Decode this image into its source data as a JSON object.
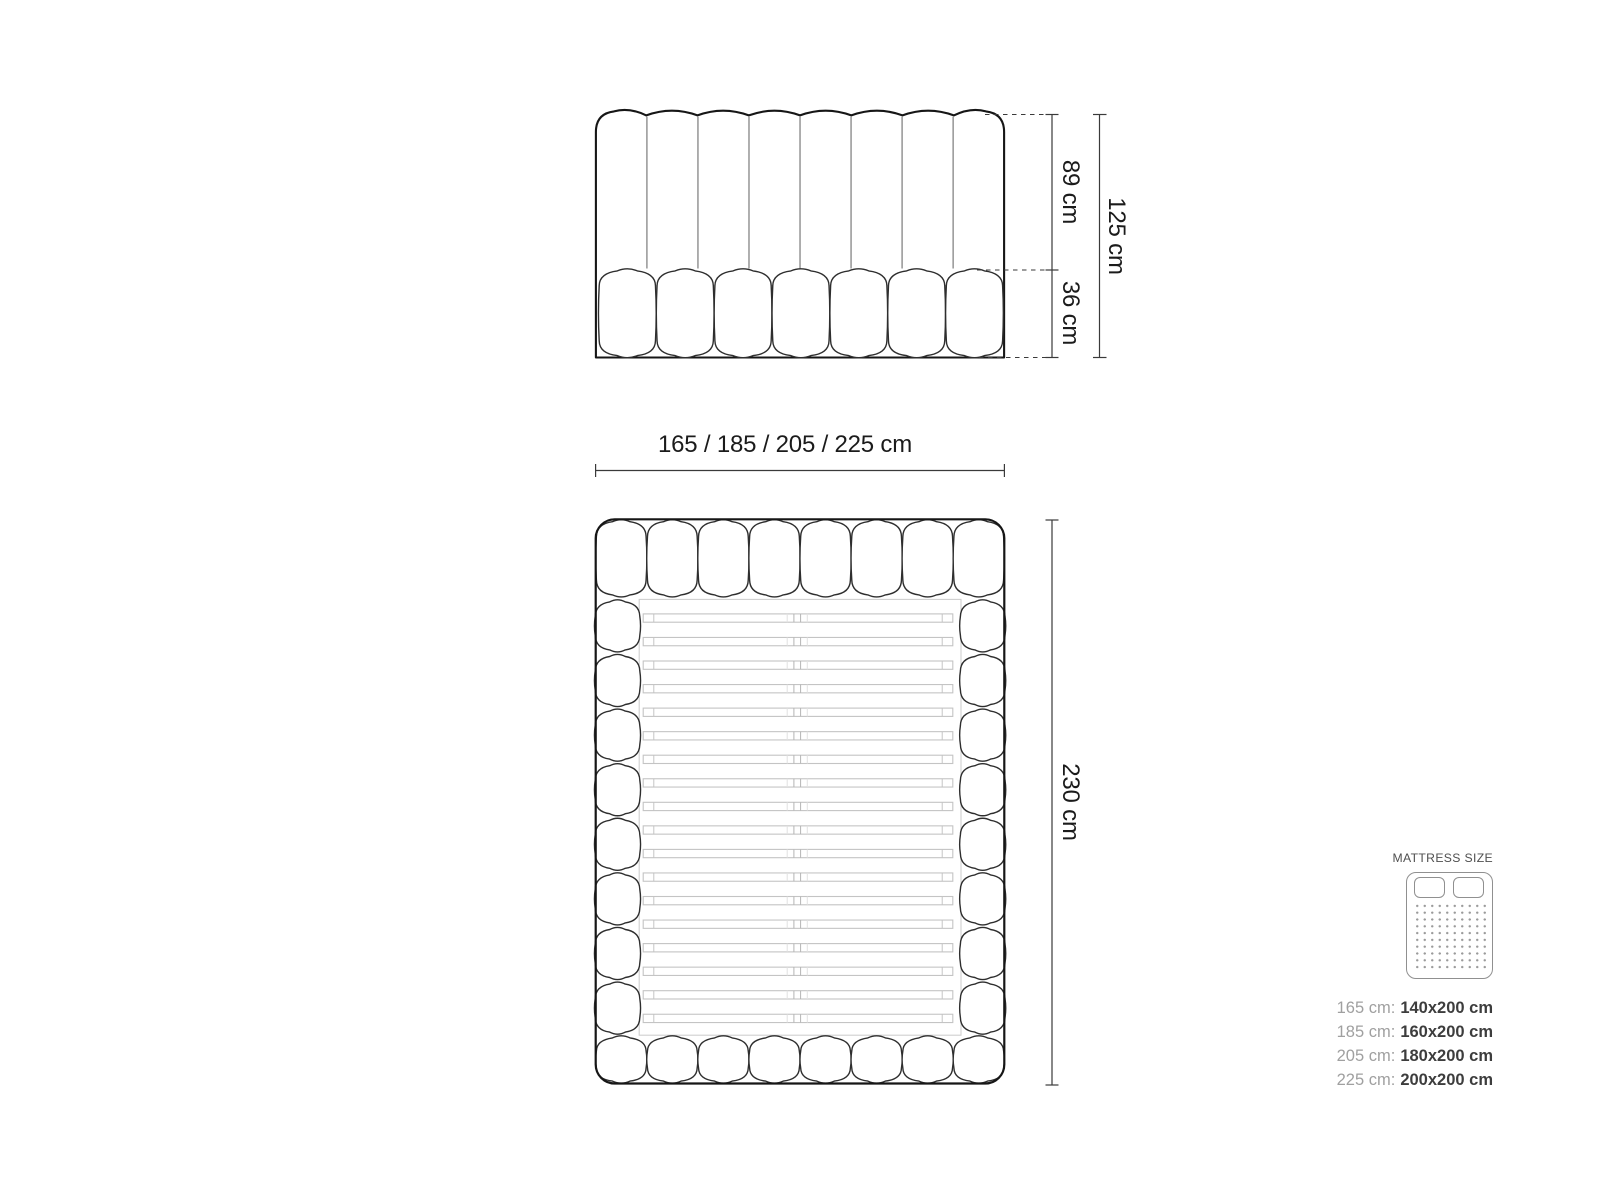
{
  "diagram": {
    "front_view": {
      "dim_upper": "89 cm",
      "dim_lower": "36 cm",
      "dim_total": "125 cm"
    },
    "top_view": {
      "dim_width": "165 / 185 / 205 / 225 cm",
      "dim_length": "230 cm"
    }
  },
  "mattress_size": {
    "title": "MATTRESS SIZE",
    "icon": "mattress-top-icon",
    "rows": [
      {
        "label": "165 cm:",
        "value": "140x200 cm"
      },
      {
        "label": "185 cm:",
        "value": "160x200 cm"
      },
      {
        "label": "205 cm:",
        "value": "180x200 cm"
      },
      {
        "label": "225 cm:",
        "value": "200x200 cm"
      }
    ]
  },
  "colors": {
    "outline_dark": "#161616",
    "outline_medium": "#2e2e2e",
    "separator_gray": "#6e6e6e",
    "slat_gray": "#c4c4c4",
    "dimension_line": "#3a3a3a",
    "label_text": "#1b1b1b",
    "legend_title": "#4f4f4f",
    "legend_label": "#a0a0a0",
    "legend_value": "#3d3d3d",
    "icon_outline": "#909090"
  }
}
